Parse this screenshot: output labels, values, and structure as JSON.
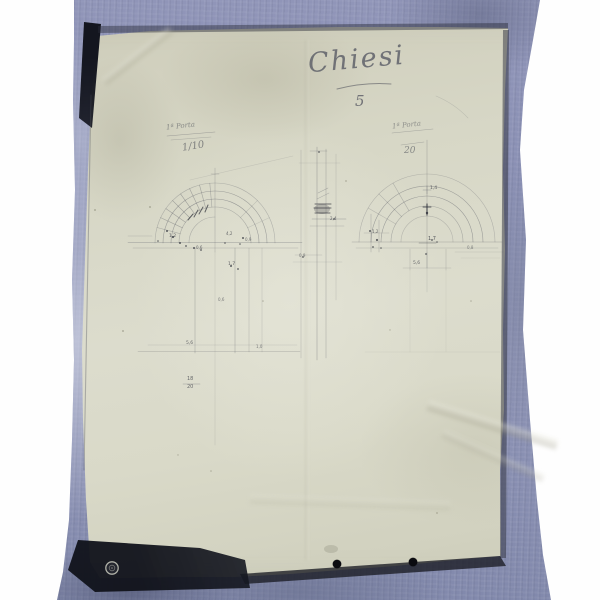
{
  "photo": {
    "sheet_title_script": "Chiesi",
    "sheet_title_number": "5",
    "left_drawing": {
      "label": "1ª Porta",
      "scale": "1/10"
    },
    "right_drawing": {
      "label": "1ª Porta",
      "scale": "20"
    },
    "annotations": [
      {
        "text": "1,2",
        "x": 169,
        "y": 235,
        "size": 4.5,
        "opacity": 0.75
      },
      {
        "text": "0,6",
        "x": 196,
        "y": 246,
        "size": 4,
        "opacity": 0.7
      },
      {
        "text": "4,2",
        "x": 226,
        "y": 232,
        "size": 4,
        "opacity": 0.7
      },
      {
        "text": "0,9",
        "x": 245,
        "y": 238,
        "size": 4,
        "opacity": 0.65
      },
      {
        "text": "1,7",
        "x": 228,
        "y": 263,
        "size": 4.5,
        "opacity": 0.75
      },
      {
        "text": "0,6",
        "x": 218,
        "y": 298,
        "size": 4,
        "opacity": 0.6
      },
      {
        "text": "5,6",
        "x": 186,
        "y": 342,
        "size": 4.5,
        "opacity": 0.7
      },
      {
        "text": "1,0",
        "x": 256,
        "y": 345,
        "size": 4,
        "opacity": 0.6
      },
      {
        "text": "18",
        "x": 187,
        "y": 377,
        "size": 5,
        "opacity": 0.7
      },
      {
        "text": "20",
        "x": 187,
        "y": 385,
        "size": 5,
        "opacity": 0.7
      },
      {
        "text": "2,4",
        "x": 330,
        "y": 217,
        "size": 4,
        "opacity": 0.7
      },
      {
        "text": "0,9",
        "x": 299,
        "y": 254,
        "size": 4,
        "opacity": 0.6
      },
      {
        "text": "1,4",
        "x": 430,
        "y": 187,
        "size": 4.5,
        "opacity": 0.75
      },
      {
        "text": "1,2",
        "x": 372,
        "y": 230,
        "size": 4,
        "opacity": 0.7
      },
      {
        "text": "1,7",
        "x": 428,
        "y": 237,
        "size": 5,
        "opacity": 0.8
      },
      {
        "text": "5,6",
        "x": 413,
        "y": 262,
        "size": 4.5,
        "opacity": 0.7
      },
      {
        "text": "0,8",
        "x": 467,
        "y": 246,
        "size": 4,
        "opacity": 0.55
      }
    ],
    "colors": {
      "background": "#ffffff",
      "cloth": "#8a90b4",
      "paper": "#d7d7c6",
      "deep_shadow": "#14161f",
      "graphite": "#4a4c58"
    }
  }
}
